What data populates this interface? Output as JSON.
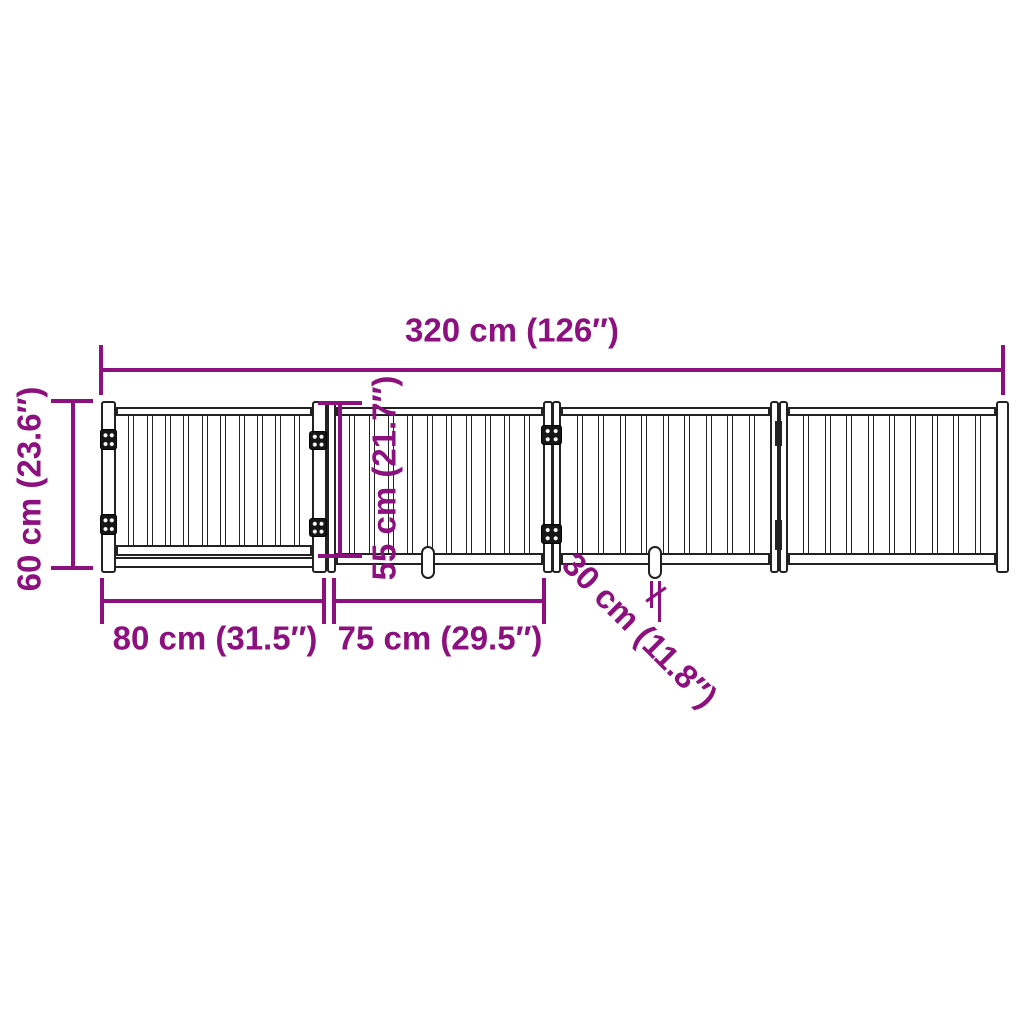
{
  "labels": {
    "total_width": "320 cm (126″)",
    "total_height": "60 cm (23.6″)",
    "inner_height": "55 cm (21.7″)",
    "section1_width": "80 cm (31.5″)",
    "section2_width": "75 cm (29.5″)",
    "foot_length": "30 cm (11.8″)"
  },
  "colors": {
    "dimension": "#8C107E",
    "outline": "#222222",
    "background": "#FFFFFF"
  },
  "geometry": {
    "gate": {
      "top": 401,
      "height": 172,
      "slat_width": 6,
      "panels": [
        {
          "x": 116,
          "w": 196,
          "slats": 10,
          "slat_top": 413,
          "slat_bottom": 547,
          "top_rail": {
            "y": 407,
            "h": 9
          },
          "bottom_rail": {
            "y": 545,
            "h": 11
          }
        },
        {
          "x": 336,
          "w": 207,
          "slats": 10,
          "slat_top": 413,
          "slat_bottom": 556,
          "top_rail": {
            "y": 407,
            "h": 9
          },
          "bottom_rail": {
            "y": 553,
            "h": 12
          }
        },
        {
          "x": 561,
          "w": 209,
          "slats": 9,
          "slat_top": 413,
          "slat_bottom": 556,
          "top_rail": {
            "y": 407,
            "h": 9
          },
          "bottom_rail": {
            "y": 553,
            "h": 12
          }
        },
        {
          "x": 788,
          "w": 208,
          "slats": 9,
          "slat_top": 413,
          "slat_bottom": 556,
          "top_rail": {
            "y": 407,
            "h": 9
          },
          "bottom_rail": {
            "y": 553,
            "h": 12
          }
        }
      ],
      "long_bar": {
        "x": 101,
        "y": 557,
        "w": 233,
        "h": 11
      },
      "posts": [
        {
          "x": 101,
          "w": 15
        },
        {
          "x": 312,
          "w": 15
        },
        {
          "x": 327,
          "w": 9
        },
        {
          "x": 543,
          "w": 10
        },
        {
          "x": 552,
          "w": 9
        },
        {
          "x": 770,
          "w": 9
        },
        {
          "x": 779,
          "w": 9
        },
        {
          "x": 996,
          "w": 13
        }
      ],
      "fold_joint": {
        "x": 777,
        "w": 3,
        "segments": [
          {
            "y": 421,
            "h": 25
          },
          {
            "y": 520,
            "h": 30
          }
        ]
      },
      "hinges": [
        {
          "x": 100,
          "y": 429,
          "w": 17,
          "h": 21
        },
        {
          "x": 100,
          "y": 514,
          "w": 17,
          "h": 21
        },
        {
          "x": 309,
          "y": 431,
          "w": 18,
          "h": 19
        },
        {
          "x": 309,
          "y": 518,
          "w": 18,
          "h": 19
        },
        {
          "x": 541,
          "y": 425,
          "w": 21,
          "h": 20
        },
        {
          "x": 541,
          "y": 524,
          "w": 21,
          "h": 20
        }
      ],
      "feet": [
        {
          "x": 421,
          "y": 546,
          "w": 14,
          "h": 33
        },
        {
          "x": 648,
          "y": 546,
          "w": 14,
          "h": 33
        }
      ]
    },
    "dims": [
      {
        "name": "dim-line-total-width",
        "x": 101,
        "y": 368,
        "w": 904,
        "h": 4
      },
      {
        "name": "dim-tick-total-width-left",
        "x": 99,
        "y": 345,
        "w": 4,
        "h": 50
      },
      {
        "name": "dim-tick-total-width-right",
        "x": 1001,
        "y": 345,
        "w": 4,
        "h": 50
      },
      {
        "name": "dim-line-total-height",
        "x": 71,
        "y": 401,
        "w": 4,
        "h": 169
      },
      {
        "name": "dim-tick-total-height-top",
        "x": 51,
        "y": 399,
        "w": 42,
        "h": 4
      },
      {
        "name": "dim-tick-total-height-bottom",
        "x": 51,
        "y": 566,
        "w": 42,
        "h": 4
      },
      {
        "name": "dim-line-inner-height",
        "x": 338,
        "y": 403,
        "w": 4,
        "h": 155
      },
      {
        "name": "dim-tick-inner-height-top",
        "x": 318,
        "y": 401,
        "w": 44,
        "h": 4
      },
      {
        "name": "dim-tick-inner-height-bottom",
        "x": 318,
        "y": 554,
        "w": 44,
        "h": 4
      },
      {
        "name": "dim-line-section1",
        "x": 102,
        "y": 599,
        "w": 222,
        "h": 4
      },
      {
        "name": "dim-tick-section1-left",
        "x": 100,
        "y": 578,
        "w": 4,
        "h": 46
      },
      {
        "name": "dim-tick-section1-right",
        "x": 322,
        "y": 578,
        "w": 4,
        "h": 46
      },
      {
        "name": "dim-line-section2",
        "x": 334,
        "y": 599,
        "w": 210,
        "h": 4
      },
      {
        "name": "dim-tick-section2-left",
        "x": 332,
        "y": 578,
        "w": 4,
        "h": 46
      },
      {
        "name": "dim-tick-section2-right",
        "x": 542,
        "y": 578,
        "w": 4,
        "h": 46
      },
      {
        "name": "dim-ext-foot-left",
        "x": 650,
        "y": 581,
        "w": 3,
        "h": 27
      },
      {
        "name": "dim-ext-foot-right",
        "x": 658,
        "y": 581,
        "w": 3,
        "h": 41
      },
      {
        "name": "dim-slash-foot",
        "x": 644,
        "y": 593,
        "w": 24,
        "h": 3,
        "rotate": -35
      }
    ]
  }
}
